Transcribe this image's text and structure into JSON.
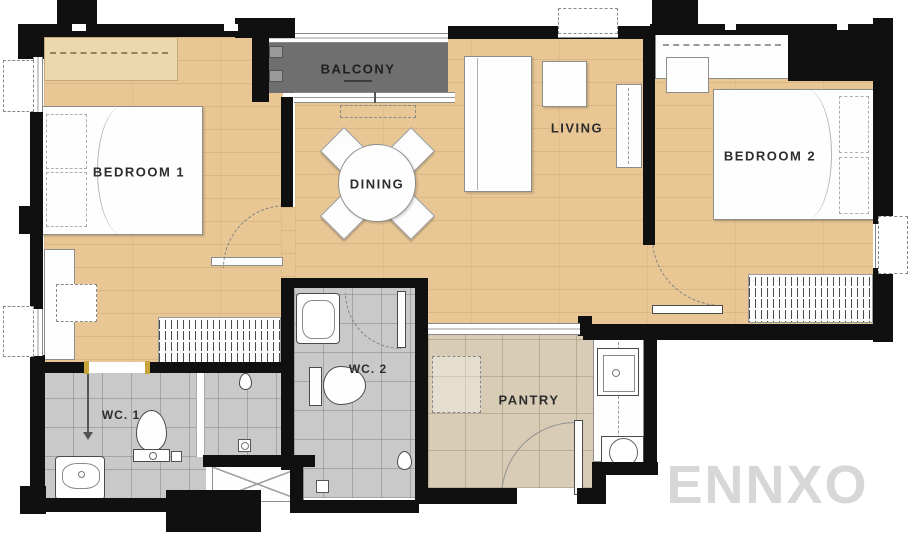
{
  "watermark": {
    "text": "ENNXO"
  },
  "rooms": {
    "bedroom1": {
      "label": "BEDROOM 1"
    },
    "bedroom2": {
      "label": "BEDROOM 2"
    },
    "living": {
      "label": "LIVING"
    },
    "dining": {
      "label": "DINING"
    },
    "balcony": {
      "label": "BALCONY"
    },
    "wc1": {
      "label": "WC. 1"
    },
    "wc2": {
      "label": "WC. 2"
    },
    "pantry": {
      "label": "PANTRY"
    }
  },
  "colors": {
    "wall": "#101010",
    "wood_floor": "#e8c795",
    "balcony_floor": "#6f6f6f",
    "wc_tile": "#c9c9c9",
    "pantry_tile": "#d8ccb6",
    "door_frame_gold": "#c9a43a",
    "watermark_gray": "#d7d7d7"
  }
}
